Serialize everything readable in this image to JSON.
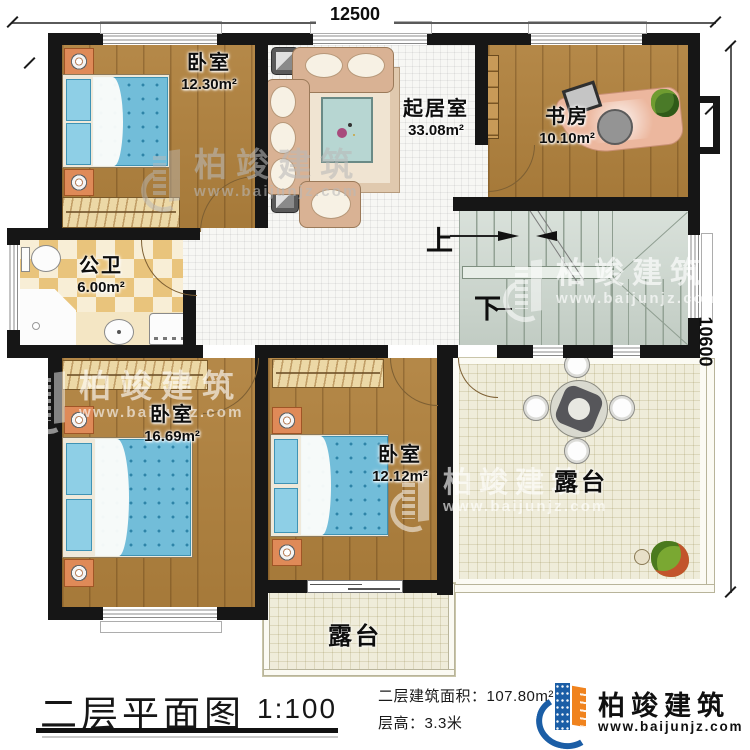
{
  "dimensions": {
    "width": "12500",
    "height": "10600"
  },
  "rooms": {
    "bedroom_top": {
      "name": "卧室",
      "area": "12.30m²"
    },
    "living_room": {
      "name": "起居室",
      "area": "33.08m²"
    },
    "study": {
      "name": "书房",
      "area": "10.10m²"
    },
    "bathroom": {
      "name": "公卫",
      "area": "6.00m²"
    },
    "bedroom_left": {
      "name": "卧室",
      "area": "16.69m²"
    },
    "bedroom_middle": {
      "name": "卧室",
      "area": "12.12m²"
    },
    "terrace_main": {
      "name": "露台"
    },
    "terrace_small": {
      "name": "露台"
    }
  },
  "stairs": {
    "up_label": "上",
    "down_label": "下"
  },
  "watermark": {
    "brand": "柏竣建筑",
    "site": "www.baijunjz.com"
  },
  "footer": {
    "title": "二层平面图",
    "scale": "1:100",
    "area_line": "二层建筑面积：107.80m²",
    "floor_height_line": "层高：3.3米",
    "brand": "柏竣建筑",
    "site": "www.baijunjz.com"
  },
  "colors": {
    "wall": "#161616",
    "wood_floor": "#b0813d",
    "bed_blue": "#72bdd9",
    "bath_tile": "#e9c47c",
    "stairs": "#ccd7ce",
    "terrace": "#efecda",
    "brand_blue": "#1b5ea6",
    "brand_orange": "#f0831e"
  }
}
